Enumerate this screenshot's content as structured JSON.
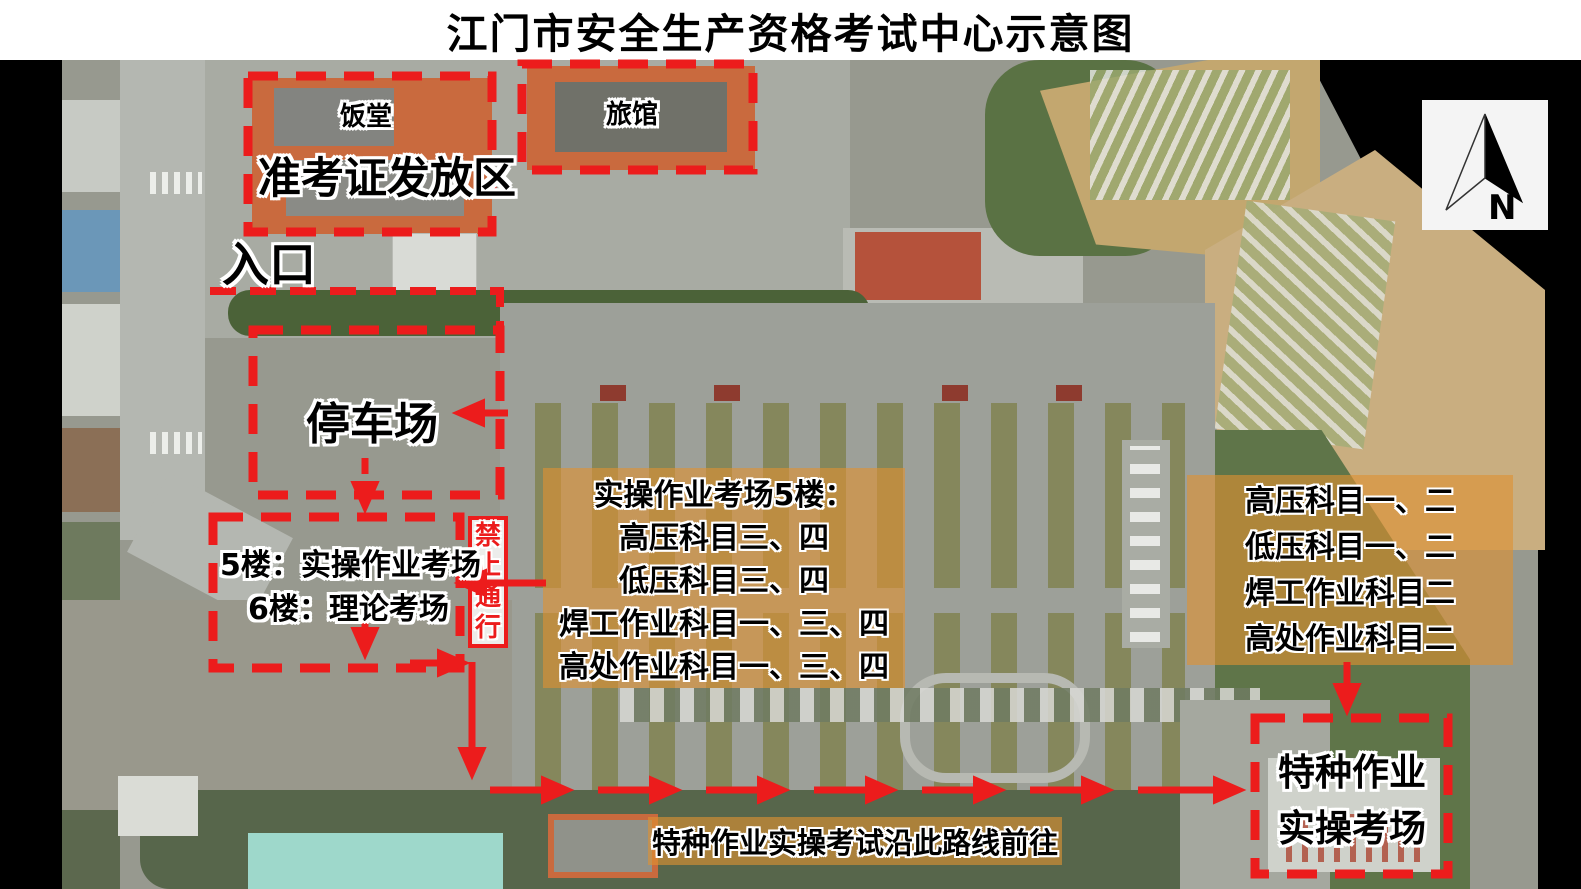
{
  "title": "江门市安全生产资格考试中心示意图",
  "areas": {
    "canteen": "饭堂",
    "ticket_issue": "准考证发放区",
    "hotel": "旅馆",
    "entrance": "入口",
    "parking": "停车场",
    "exam_building_f5": "5楼：实操作业考场",
    "exam_building_f6": "6楼：理论考场",
    "no_passage": "禁止通行",
    "special_site_line1": "特种作业",
    "special_site_line2": "实操考场",
    "route_note": "特种作业实操考试沿此路线前往"
  },
  "center_board": {
    "lines": [
      "实操作业考场5楼：",
      "高压科目三、四",
      "低压科目三、四",
      "焊工作业科目一、三、四",
      "高处作业科目一、三、四"
    ]
  },
  "right_board": {
    "lines": [
      "高压科目一、二",
      "低压科目一、二",
      "焊工作业科目二",
      "高处作业科目二"
    ]
  },
  "compass": {
    "label": "N"
  },
  "colors": {
    "annotation_red": "#ec1c1c",
    "overlay_orange": "#df9232",
    "building_orange": "#c96a3e",
    "pond_teal": "#9ed8cb"
  }
}
